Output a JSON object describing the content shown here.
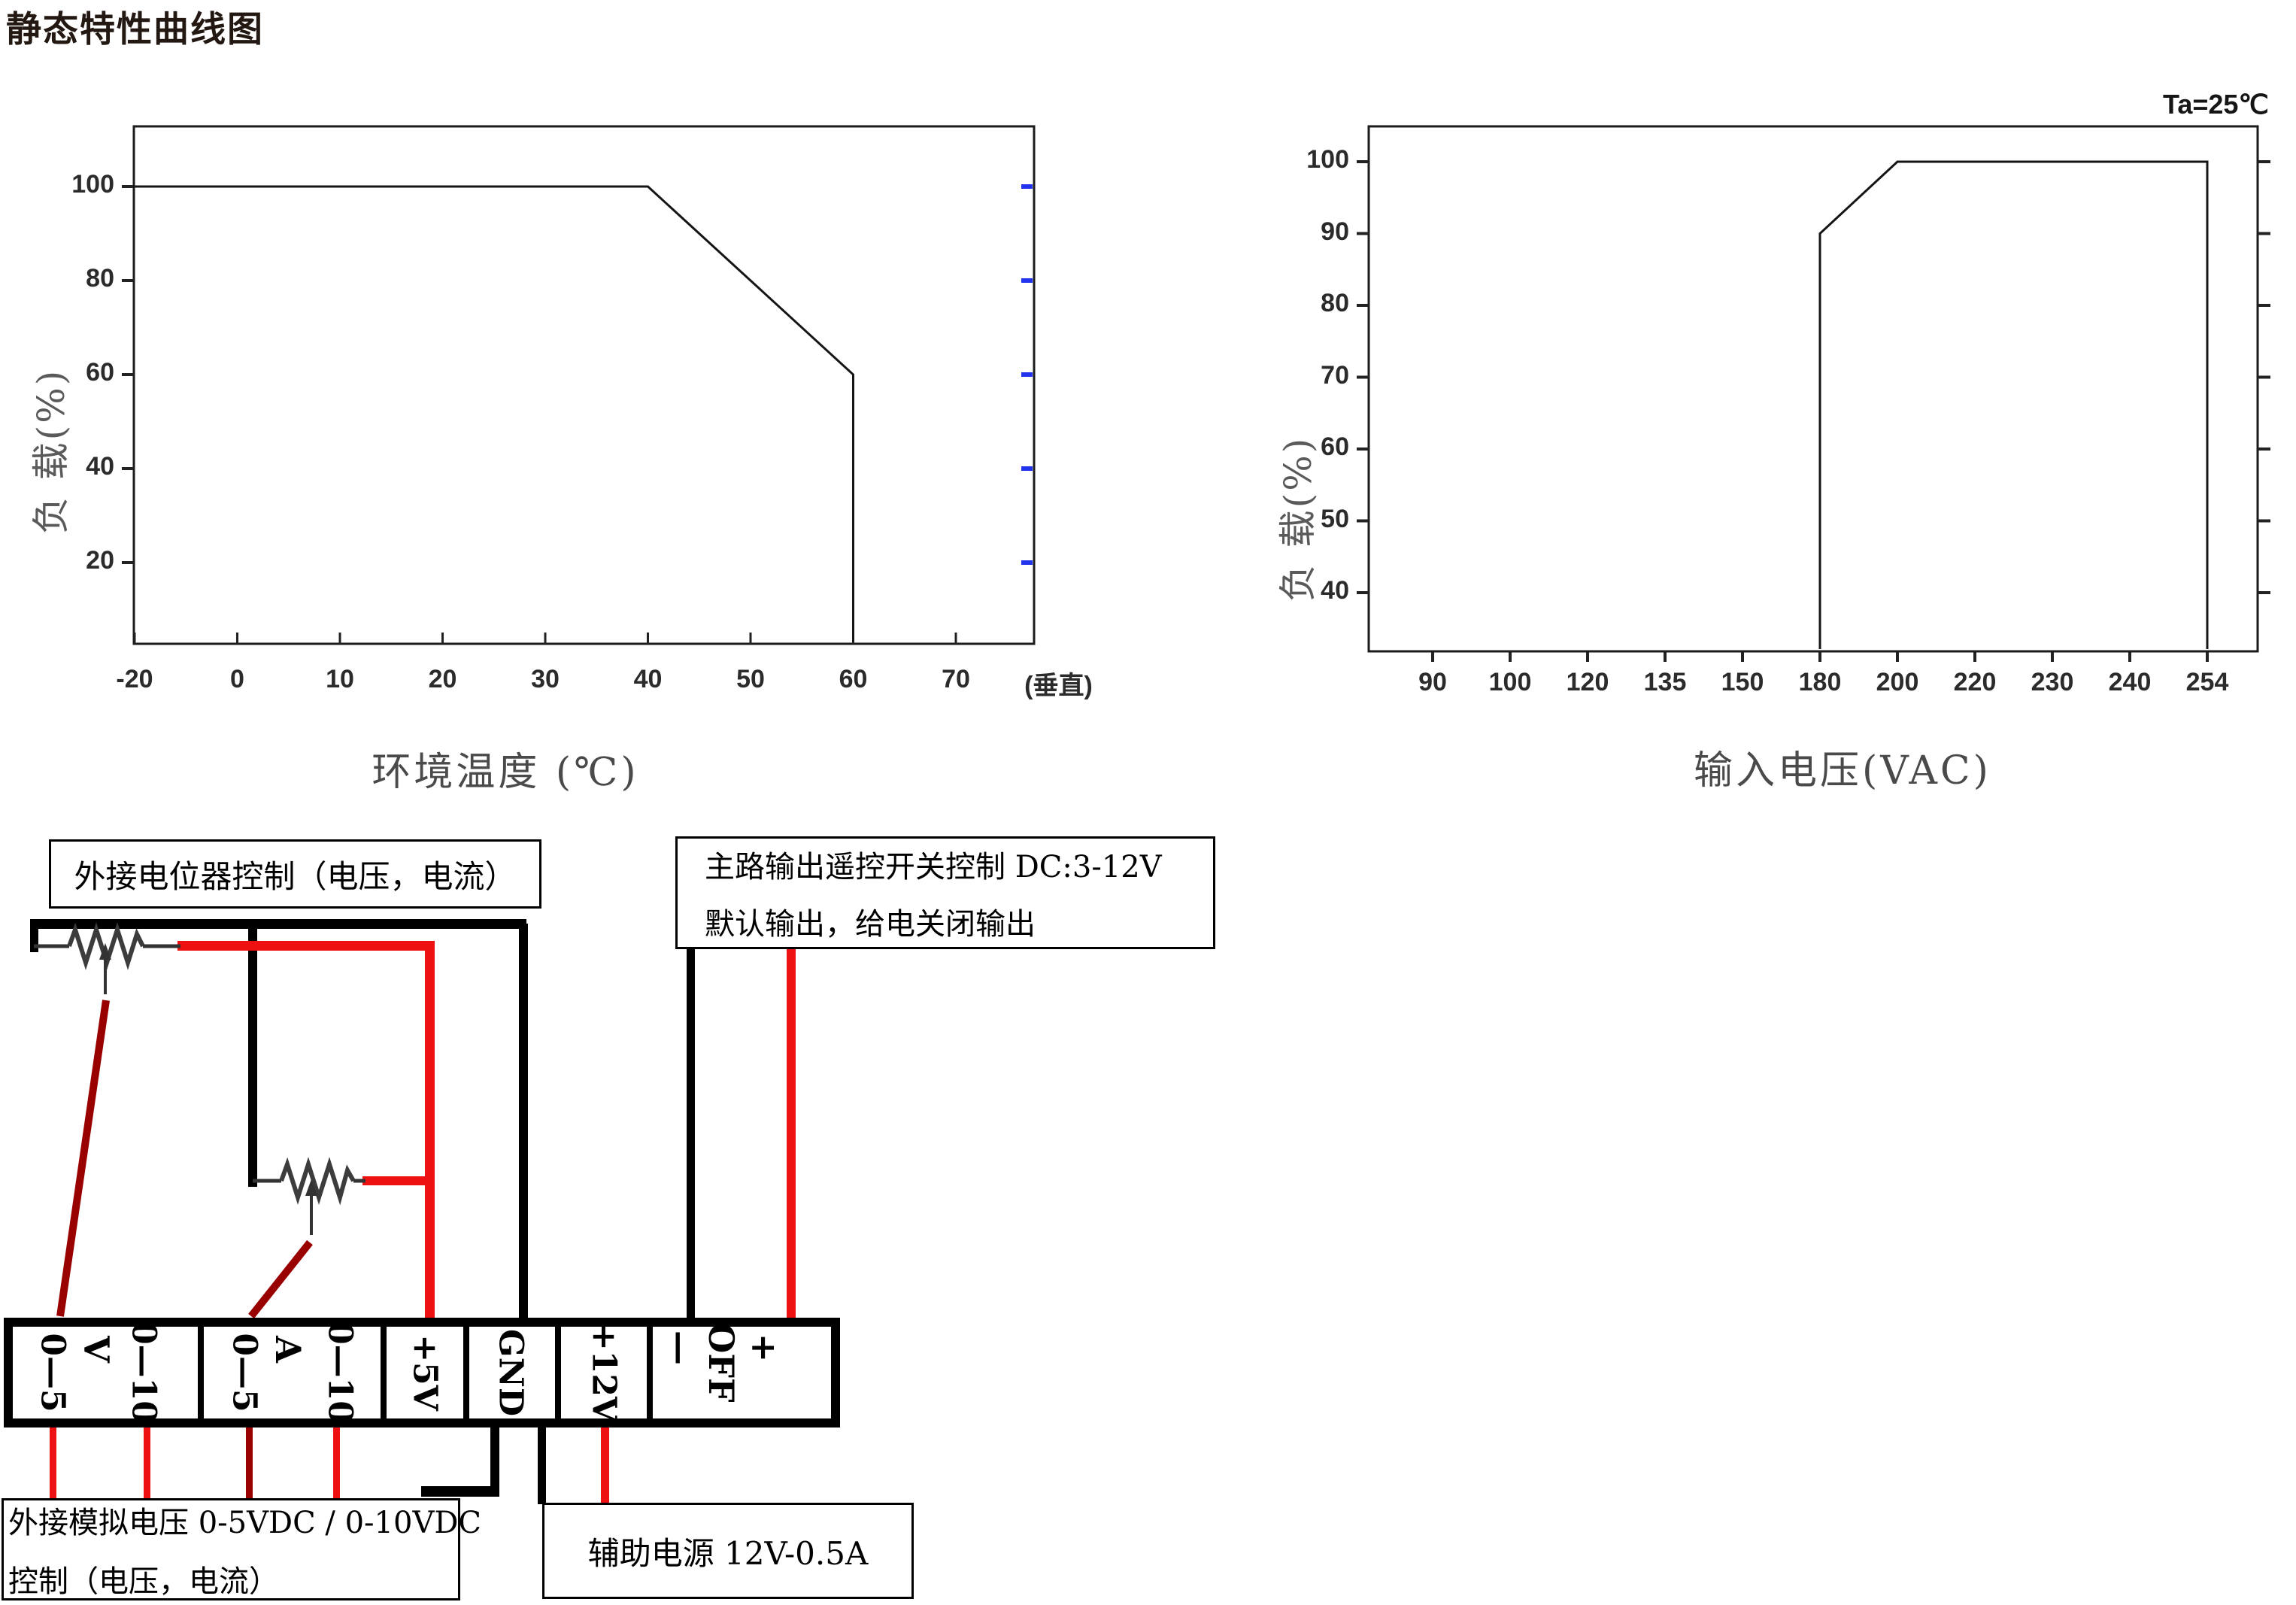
{
  "title": "静态特性曲线图",
  "chart_data": [
    {
      "type": "line",
      "name": "load-vs-ambient-temperature",
      "title": "",
      "xlabel": "环境温度 (℃)",
      "ylabel": "负 载(%)",
      "x_ticks": [
        "-20",
        "0",
        "10",
        "20",
        "30",
        "40",
        "50",
        "60",
        "70",
        "(垂直)"
      ],
      "y_ticks": [
        100,
        80,
        60,
        40,
        20
      ],
      "ylim": [
        0,
        112
      ],
      "grid": "off",
      "series": [
        {
          "name": "load_percent_vs_temp",
          "points": [
            [
              -20,
              100
            ],
            [
              40,
              100
            ],
            [
              60,
              60
            ],
            [
              60,
              0
            ]
          ]
        }
      ],
      "annotation": ""
    },
    {
      "type": "line",
      "name": "load-vs-input-voltage",
      "title": "",
      "xlabel": "输入电压(VAC)",
      "ylabel": "负 载(%)",
      "x_ticks": [
        "90",
        "100",
        "120",
        "135",
        "150",
        "180",
        "200",
        "220",
        "230",
        "240",
        "254"
      ],
      "y_ticks": [
        100,
        90,
        80,
        70,
        60,
        50,
        40
      ],
      "ylim": [
        30,
        105
      ],
      "grid": "off",
      "series": [
        {
          "name": "load_percent_vs_vin",
          "points": [
            [
              180,
              0
            ],
            [
              180,
              90
            ],
            [
              200,
              100
            ],
            [
              254,
              100
            ],
            [
              254,
              0
            ]
          ]
        }
      ],
      "annotation": "Ta=25℃"
    }
  ],
  "wiring": {
    "callouts": {
      "potentiometer": "外接电位器控制（电压，电流）",
      "remote_line1": "主路输出遥控开关控制 DC:3-12V",
      "remote_line2": "默认输出，给电关闭输出",
      "analog_line1": "外接模拟电压 0-5VDC / 0-10VDC",
      "analog_line2": "控制（电压，电流）",
      "aux": "辅助电源 12V-0.5A"
    },
    "terminals": {
      "groups": [
        {
          "label": "V",
          "pins": [
            "0—5",
            "0—10"
          ]
        },
        {
          "label": "A",
          "pins": [
            "0—5",
            "0—10"
          ]
        },
        {
          "label": "",
          "pins": [
            "+5V"
          ]
        },
        {
          "label": "",
          "pins": [
            "GND"
          ]
        },
        {
          "label": "",
          "pins": [
            "+12V"
          ]
        },
        {
          "label": "OFF",
          "pins": [
            "—",
            "+"
          ]
        }
      ]
    },
    "colors": {
      "wire_red": "#ee1111",
      "wire_dark_red": "#990000",
      "wire_black": "#000000",
      "blue_tick": "#2233ee"
    }
  }
}
